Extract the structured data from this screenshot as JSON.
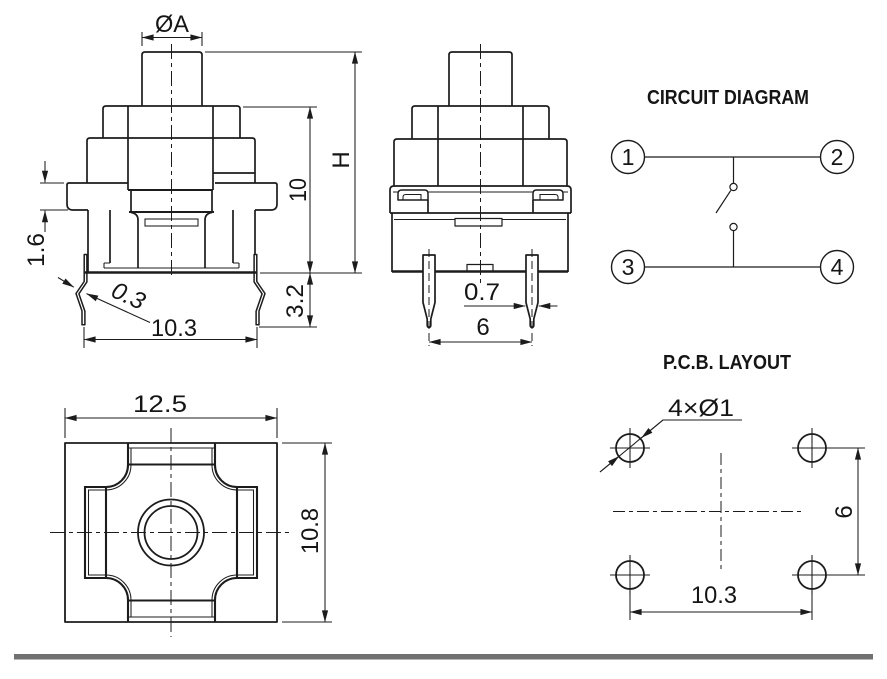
{
  "drawing": {
    "front": {
      "dia": "ØA",
      "total_height": "H",
      "body_height": "10",
      "flange_thickness": "1.6",
      "lead_thickness": "0.3",
      "lead_pitch": "10.3",
      "lead_protrusion": "3.2"
    },
    "side": {
      "pin_width": "0.7",
      "pin_pitch": "6"
    },
    "bottom": {
      "body_width": "12.5",
      "body_depth": "10.8"
    },
    "circuit": {
      "title": "CIRCUIT DIAGRAM",
      "terminals": [
        "1",
        "2",
        "3",
        "4"
      ]
    },
    "pcb": {
      "title": "P.C.B. LAYOUT",
      "hole_note": "4×Ø1",
      "pitch_x": "10.3",
      "pitch_y": "6"
    },
    "colors": {
      "line": "#1c1c1c",
      "separator": "#717171",
      "background": "#ffffff"
    }
  }
}
